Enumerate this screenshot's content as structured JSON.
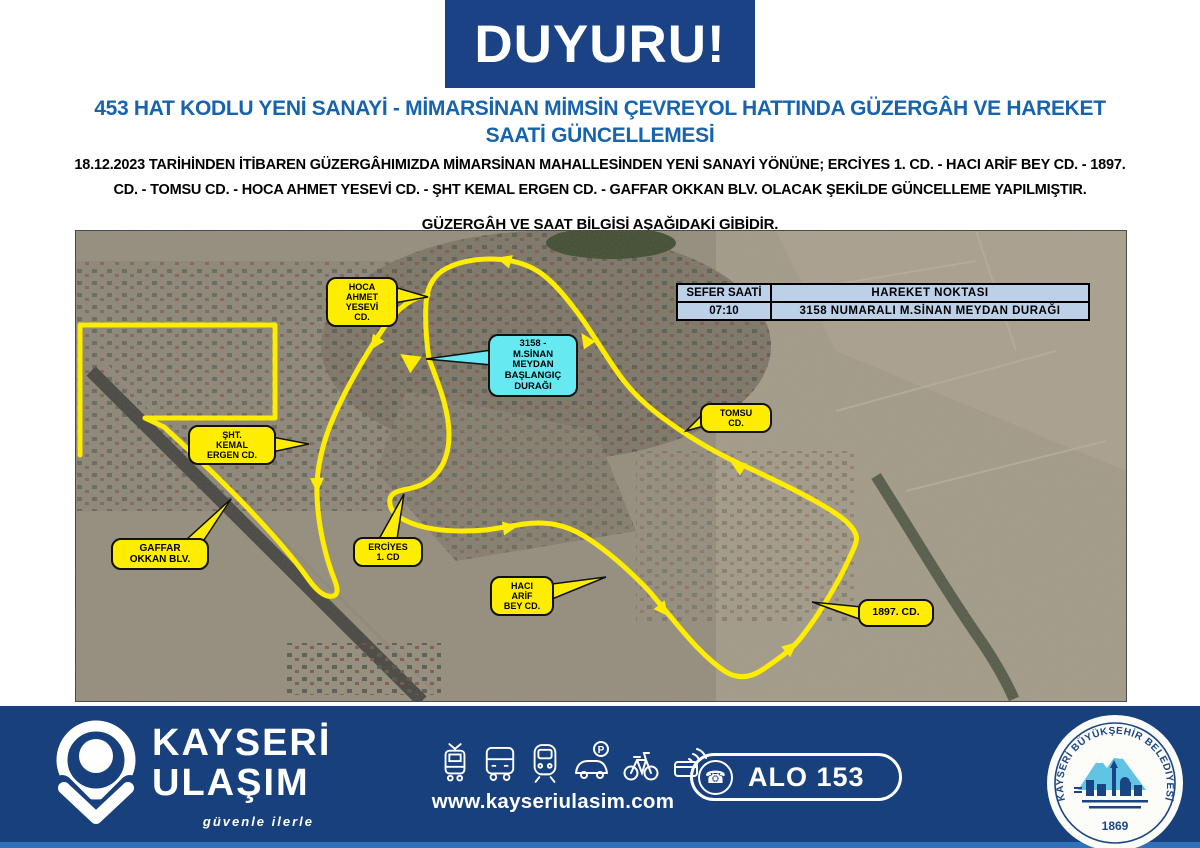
{
  "announcement": "DUYURU!",
  "title": {
    "line1": "453 HAT KODLU YENİ SANAYİ - MİMARSİNAN MİMSİN ÇEVREYOL HATTINDA GÜZERGÂH VE HAREKET",
    "line2": "SAATİ GÜNCELLEMESİ"
  },
  "intro": {
    "line1": "18.12.2023 TARİHİNDEN İTİBAREN GÜZERGÂHIMIZDA MİMARSİNAN MAHALLESİNDEN YENİ SANAYİ YÖNÜNE;  ERCİYES 1. CD. - HACI ARİF BEY CD. - 1897.",
    "line2": "CD. - TOMSU CD. - HOCA AHMET YESEVİ CD. - ŞHT KEMAL ERGEN CD. - GAFFAR OKKAN BLV.  OLACAK ŞEKİLDE GÜNCELLEME YAPILMIŞTIR.",
    "line3": "GÜZERGÂH VE SAAT BİLGİSİ AŞAĞIDAKİ GİBİDİR."
  },
  "map": {
    "labels": {
      "hoca": "HOCA\nAHMET\nYESEVİ\nCD.",
      "start": "3158 -\nM.SİNAN\nMEYDAN\nBAŞLANGIÇ\nDURAĞI",
      "tomsu": "TOMSU\nCD.",
      "sht": "ŞHT.\nKEMAL\nERGEN CD.",
      "erciyes": "ERCİYES\n1. CD",
      "gaffar": "GAFFAR\nOKKAN BLV.",
      "haci": "HACI\nARİF\nBEY CD.",
      "cd1897": "1897. CD."
    },
    "table": {
      "col1": "SEFER SAATİ",
      "col2": "HAREKET NOKTASI",
      "time": "07:10",
      "point": "3158 NUMARALI  M.SİNAN MEYDAN DURAĞI"
    }
  },
  "footer": {
    "brand1": "KAYSERİ",
    "brand2": "ULAŞIM",
    "slogan": "güvenle ilerle",
    "website": "www.kayseriulasim.com",
    "phone": "ALO 153",
    "phone_glyph": "☎",
    "parking_letter": "P",
    "seal_top": "KAYSERİ BÜYÜKŞEHİR BELEDİYESİ",
    "seal_year": "1869"
  },
  "colors": {
    "banner_navy": "#1b4284",
    "footer_navy": "#17407d",
    "title_blue": "#1763ad",
    "route_yellow": "#ffed00",
    "start_cyan": "#67e9f2",
    "table_blue": "#bcd1e8"
  }
}
